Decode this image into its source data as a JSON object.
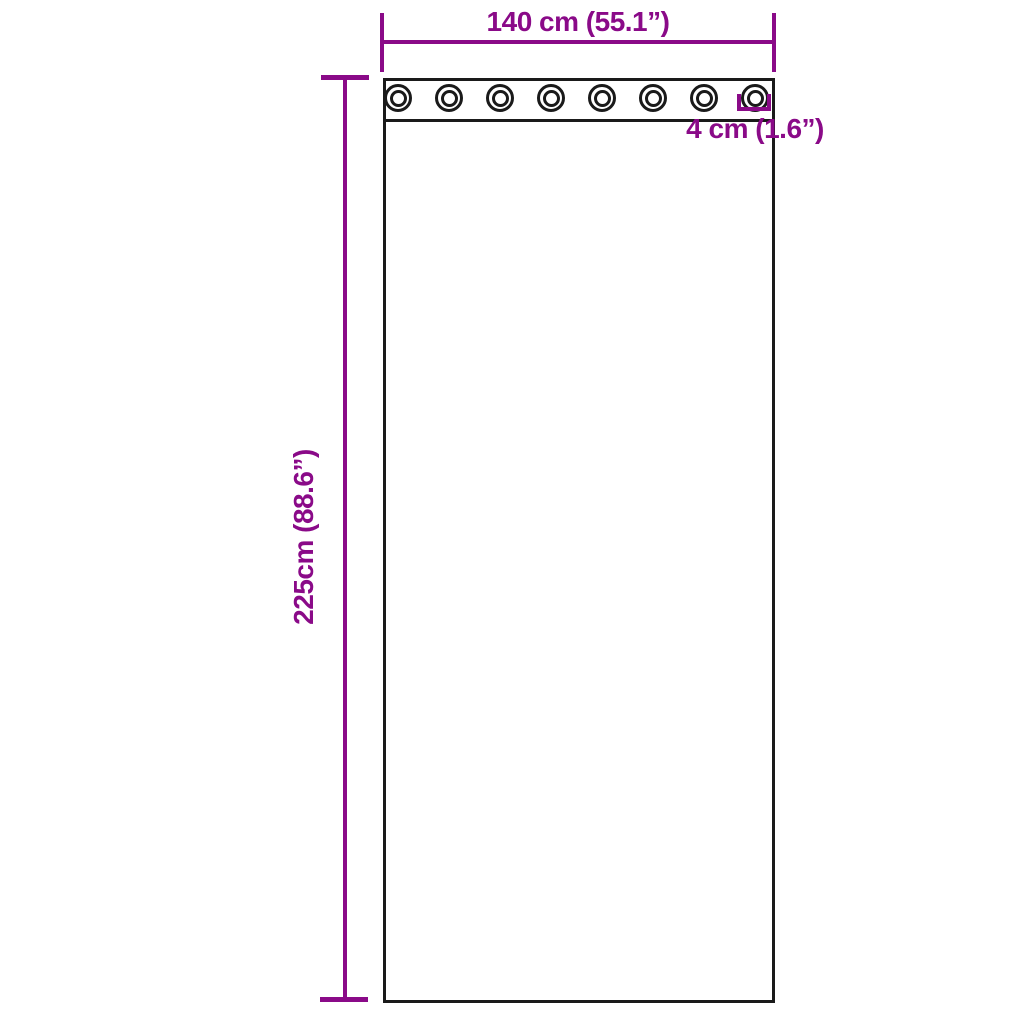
{
  "diagram": {
    "type": "product-dimension-diagram",
    "subject": "grommet curtain panel",
    "background_color": "#ffffff",
    "accent_color": "#8a0a88",
    "outline_color": "#1a1a1a",
    "labels": {
      "width": "140 cm (55.1”)",
      "height": "225cm (88.6”)",
      "grommet": "4 cm (1.6”)"
    },
    "grommets": {
      "count": 8
    }
  }
}
